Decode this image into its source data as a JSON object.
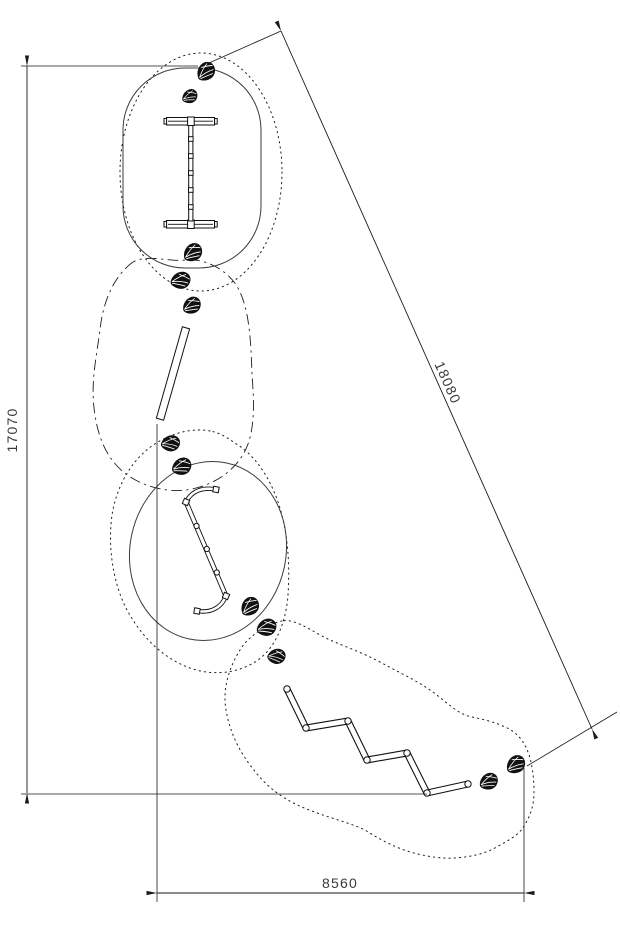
{
  "drawing": {
    "type_note": "playground equipment site plan, top view",
    "dimensions": {
      "vertical": "17070",
      "diagonal": "18080",
      "horizontal": "8560"
    },
    "colors": {
      "line": "#1a1a1a",
      "dimension_text": "#3a3a3a",
      "background": "#ffffff"
    }
  }
}
